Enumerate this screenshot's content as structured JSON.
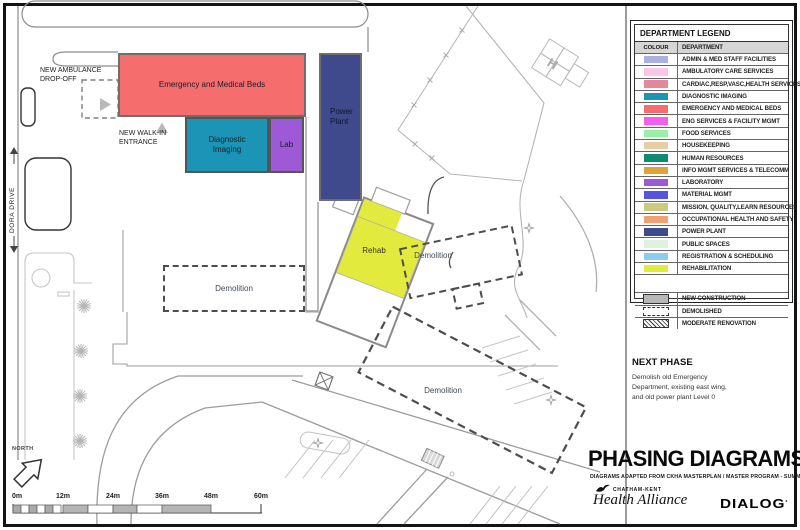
{
  "sheet": {
    "legend": {
      "title": "DEPARTMENT LEGEND",
      "columns": {
        "colour": "COLOUR",
        "department": "DEPARTMENT"
      },
      "departments": [
        {
          "name": "ADMIN & MED STAFF FACILITIES",
          "color": "#aab1e1"
        },
        {
          "name": "AMBULATORY CARE SERVICES",
          "color": "#f7c7e3"
        },
        {
          "name": "CARDIAC,RESP,VASC,HEALTH SERVICES",
          "color": "#e4879d"
        },
        {
          "name": "DIAGNOSTIC IMAGING",
          "color": "#1b94b5"
        },
        {
          "name": "EMERGENCY AND MEDICAL BEDS",
          "color": "#f56d6d"
        },
        {
          "name": "ENG SERVICES & FACILITY MGMT",
          "color": "#f65ef0"
        },
        {
          "name": "FOOD SERVICES",
          "color": "#99efa5"
        },
        {
          "name": "HOUSEKEEPING",
          "color": "#e7cda4"
        },
        {
          "name": "HUMAN RESOURCES",
          "color": "#0f8a73"
        },
        {
          "name": "INFO MGMT SERVICES & TELECOMM",
          "color": "#e2a235"
        },
        {
          "name": "LABORATORY",
          "color": "#9e59d6"
        },
        {
          "name": "MATERIAL MGMT",
          "color": "#5753e0"
        },
        {
          "name": "MISSION, QUALITY,LEARN RESOURCES",
          "color": "#cbcb80"
        },
        {
          "name": "OCCUPATIONAL HEALTH AND SAFETY",
          "color": "#f2a270"
        },
        {
          "name": "POWER PLANT",
          "color": "#3e4a8c"
        },
        {
          "name": "PUBLIC SPACES",
          "color": "#dff2df"
        },
        {
          "name": "REGISTRATION & SCHEDULING",
          "color": "#8accf2"
        },
        {
          "name": "REHABILITATION",
          "color": "#e3ea3e"
        }
      ],
      "construction_types": [
        {
          "name": "NEW CONSTRUCTION"
        },
        {
          "name": "DEMOLISHED"
        },
        {
          "name": "MODERATE RENOVATION"
        }
      ]
    },
    "plan": {
      "buildings": [
        {
          "id": "emergency",
          "label": "Emergency and Medical Beds",
          "color": "#f56d6d"
        },
        {
          "id": "diagnostic-imaging",
          "label": "Diagnostic\nImaging",
          "color": "#1b94b5"
        },
        {
          "id": "lab",
          "label": "Lab",
          "color": "#9e59d6"
        },
        {
          "id": "power-plant",
          "label": "Power\nPlant",
          "color": "#3e4a8c"
        },
        {
          "id": "rehab",
          "label": "Rehab",
          "color": "#e3ea3e"
        }
      ],
      "demolition_zones": [
        "Demolition",
        "Demolition",
        "Demolition"
      ],
      "annotations": {
        "ambulance_dropoff": "NEW AMBULANCE\nDROP-OFF",
        "walk_in_entrance": "NEW WALK-IN\nENTRANCE",
        "street": "DORA DRIVE",
        "north": "NORTH",
        "helipad": "H"
      },
      "scale_bar": {
        "labels": [
          "0m",
          "12m",
          "24m",
          "36m",
          "48m",
          "60m"
        ]
      }
    },
    "title_block": {
      "next_phase": {
        "heading": "NEXT PHASE",
        "body": "Demolish old Emergency\nDepartment, existing east wing,\nand old power plant Level 0"
      },
      "title": "PHASING DIAGRAMS",
      "subtitle": "DIAGRAMS ADAPTED  FROM CKHA MASTERPLAN / MASTER PROGRAM - SUMMER 2019",
      "ckha_name_top": "CHATHAM-KENT",
      "ckha_name": "Health Alliance",
      "dialog": "DIALOG"
    }
  }
}
